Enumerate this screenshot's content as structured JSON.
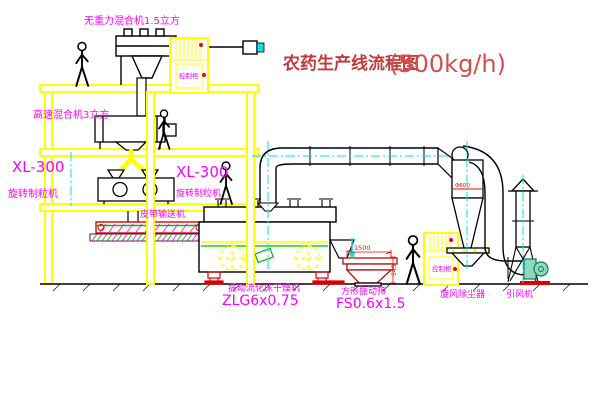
{
  "title": {
    "text": "农药生产线流程图",
    "capacity": "(500kg/h)"
  },
  "equipment": {
    "gravity_mixer": {
      "label": "无重力混合机1.5立方"
    },
    "high_speed_mixer": {
      "label": "高速混合机3立方"
    },
    "granulator_left": {
      "model": "XL-300",
      "label": "旋转制粒机"
    },
    "granulator_mid": {
      "model": "XL-300",
      "label": "旋转制粒机"
    },
    "belt_conveyor": {
      "label": "皮带输送机"
    },
    "fluid_bed_dryer": {
      "label": "振动流化床干燥机",
      "model": "ZLG6x0.75"
    },
    "square_sieve": {
      "label": "方形振动筛",
      "model": "FS0.6x1.5"
    },
    "cyclone": {
      "label": "旋风除尘器"
    },
    "induced_draft_fan": {
      "label": "引风机"
    },
    "control_cabinet": {
      "label": "控制柜"
    }
  },
  "dimensions": {
    "sieve_length": "1500",
    "sieve_height": "545",
    "cyclone_diameter": "Φ600"
  },
  "colors": {
    "structure_yellow": "#ffff00",
    "label_magenta": "#ff00ff",
    "title_red": "#c23b3b",
    "dim_red": "#ff0000",
    "centerline_cyan": "#00e5e5",
    "accent_green": "#00bb00",
    "machine_red": "#cc1111",
    "fan_teal": "#8fd8c0"
  }
}
